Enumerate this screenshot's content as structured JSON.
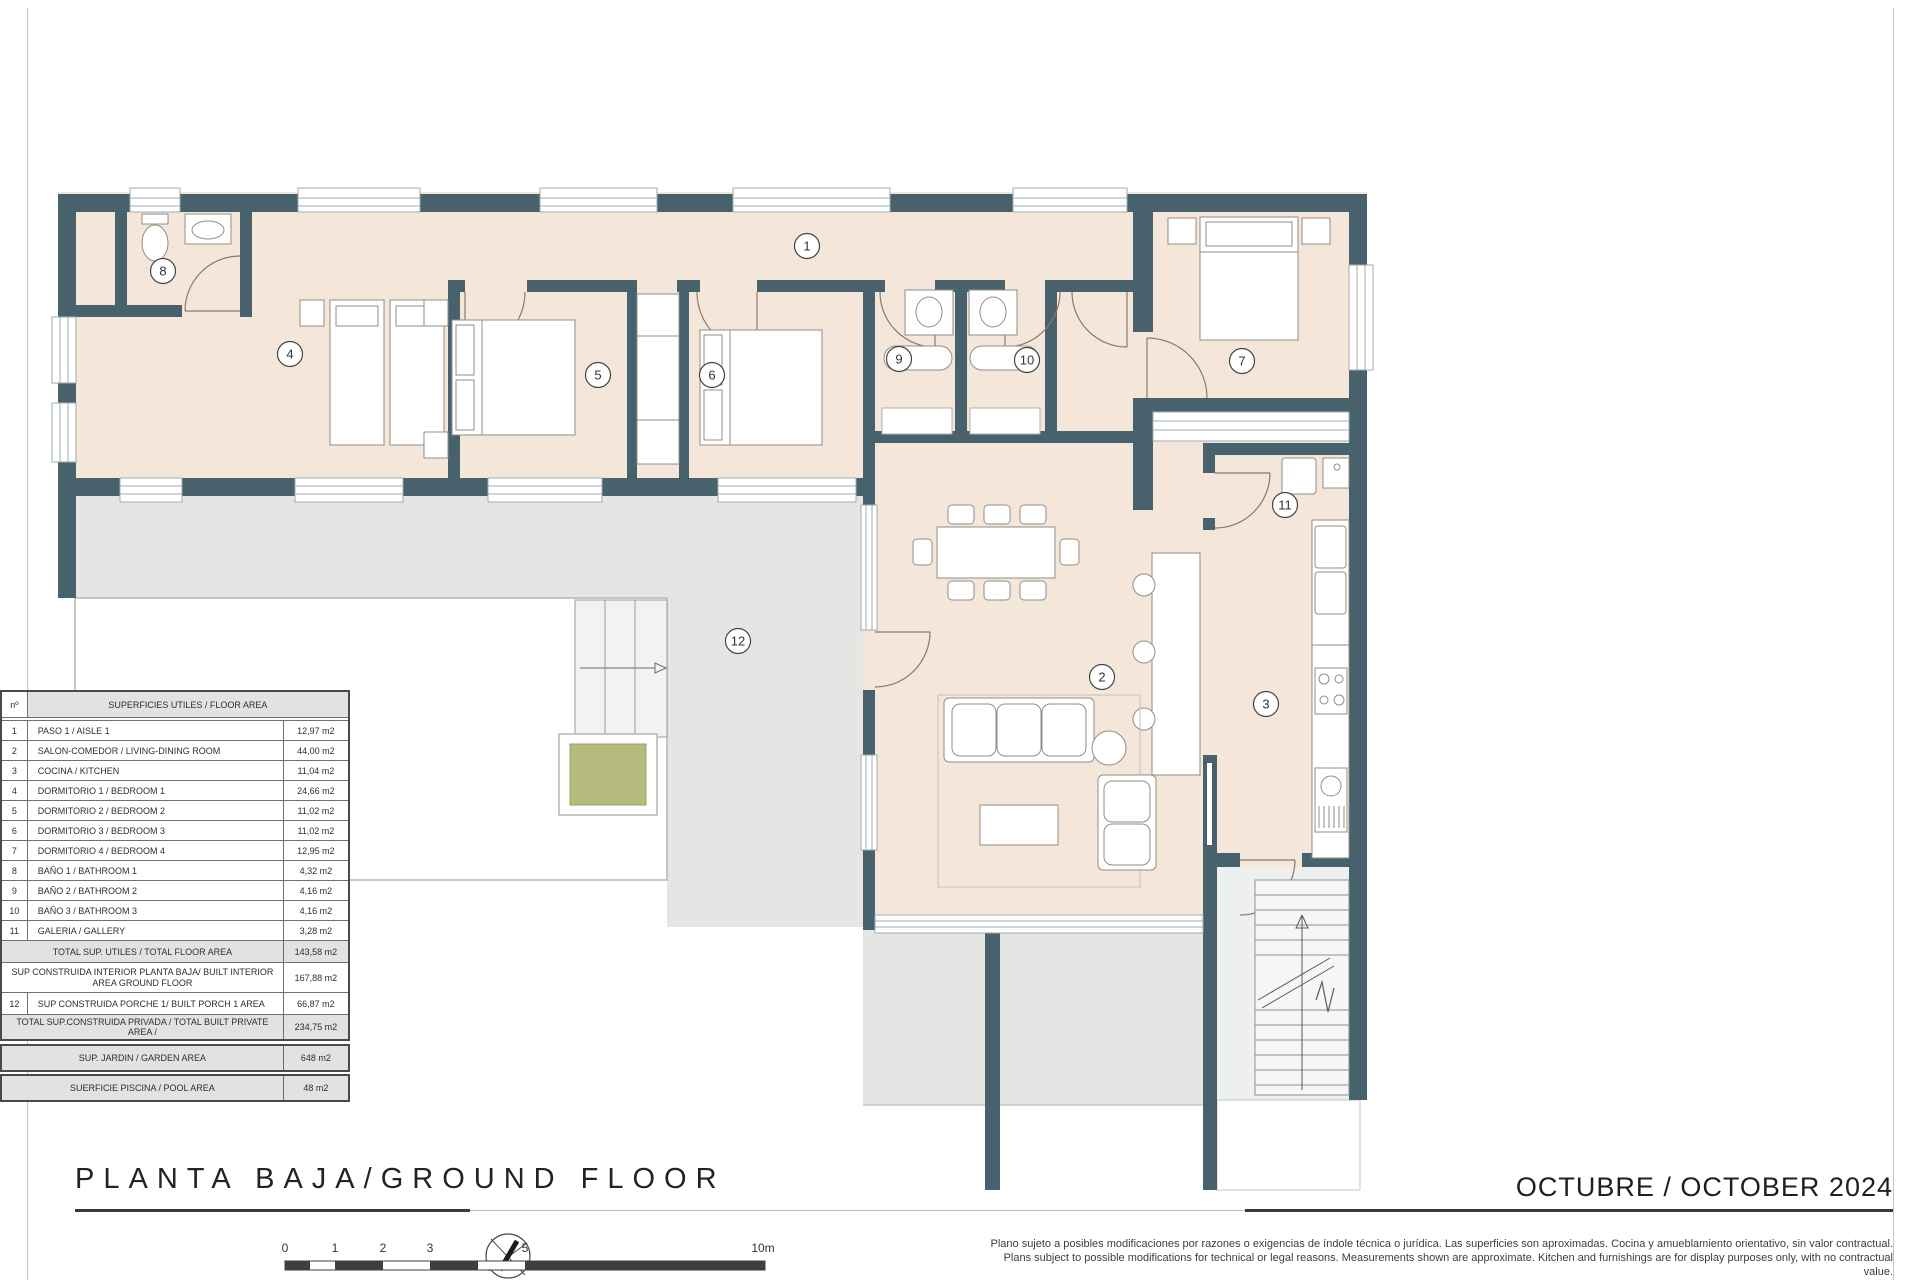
{
  "title": "PLANTA BAJA/GROUND FLOOR",
  "date": "OCTUBRE / OCTOBER 2024",
  "disclaimer": {
    "line1": "Plano sujeto a posibles modificaciones por razones o exigencias de índole técnica o jurídica. Las superficies son aproximadas. Cocina y amueblamiento orientativo, sin valor contractual.",
    "line2": "Plans subject to possible modifications for technical or legal reasons. Measurements shown are approximate. Kitchen and furnishings are for display purposes only, with no contractual value."
  },
  "scale_bar": {
    "labels": [
      "0",
      "1",
      "2",
      "3",
      "5",
      "10m"
    ]
  },
  "plan": {
    "labels": [
      "1",
      "2",
      "3",
      "4",
      "5",
      "6",
      "7",
      "8",
      "9",
      "10",
      "11",
      "12"
    ]
  },
  "colors": {
    "wall": "#47626d",
    "room_fill": "#f4e7da",
    "terrace_gray": "#e5e6e3",
    "planter_green": "#b7ba7d",
    "accent_dark": "#3a3a3a"
  },
  "table": {
    "header": {
      "num": "nº",
      "title": "SUPERFICIES UTILES  / FLOOR AREA"
    },
    "rooms": [
      {
        "num": "1",
        "label": "PASO 1 / AISLE 1",
        "area": "12,97 m2"
      },
      {
        "num": "2",
        "label": "SALON-COMEDOR /  LIVING-DINING ROOM",
        "area": "44,00 m2"
      },
      {
        "num": "3",
        "label": "COCINA / KITCHEN",
        "area": "11,04 m2"
      },
      {
        "num": "4",
        "label": "DORMITORIO 1 / BEDROOM 1",
        "area": "24,66 m2"
      },
      {
        "num": "5",
        "label": "DORMITORIO 2 / BEDROOM 2",
        "area": "11,02 m2"
      },
      {
        "num": "6",
        "label": "DORMITORIO 3 / BEDROOM 3",
        "area": "11,02 m2"
      },
      {
        "num": "7",
        "label": "DORMITORIO 4 / BEDROOM 4",
        "area": "12,95 m2"
      },
      {
        "num": "8",
        "label": "BAÑO 1 / BATHROOM 1",
        "area": "4,32 m2"
      },
      {
        "num": "9",
        "label": "BAÑO 2 / BATHROOM 2",
        "area": "4,16 m2"
      },
      {
        "num": "10",
        "label": "BAÑO 3 / BATHROOM 3",
        "area": "4,16 m2"
      },
      {
        "num": "11",
        "label": "GALERIA / GALLERY",
        "area": "3,28 m2"
      }
    ],
    "total_floor": {
      "label": "TOTAL SUP. UTILES / TOTAL FLOOR AREA",
      "area": "143,58 m2"
    },
    "built_interior": {
      "label": "SUP CONSTRUIDA INTERIOR PLANTA BAJA/ BUILT INTERIOR AREA GROUND FLOOR",
      "area": "167,88 m2"
    },
    "porch": {
      "num": "12",
      "label": "SUP CONSTRUIDA PORCHE 1/ BUILT PORCH 1 AREA",
      "area": "66,87 m2"
    },
    "total_private": {
      "label": "TOTAL SUP.CONSTRUIDA PRIVADA / TOTAL  BUILT PRIVATE AREA /",
      "area": "234,75 m2"
    },
    "garden": {
      "label": "SUP. JARDIN / GARDEN AREA",
      "area": "648 m2"
    },
    "pool": {
      "label": "SUERFICIE PISCINA / POOL AREA",
      "area": "48 m2"
    }
  }
}
